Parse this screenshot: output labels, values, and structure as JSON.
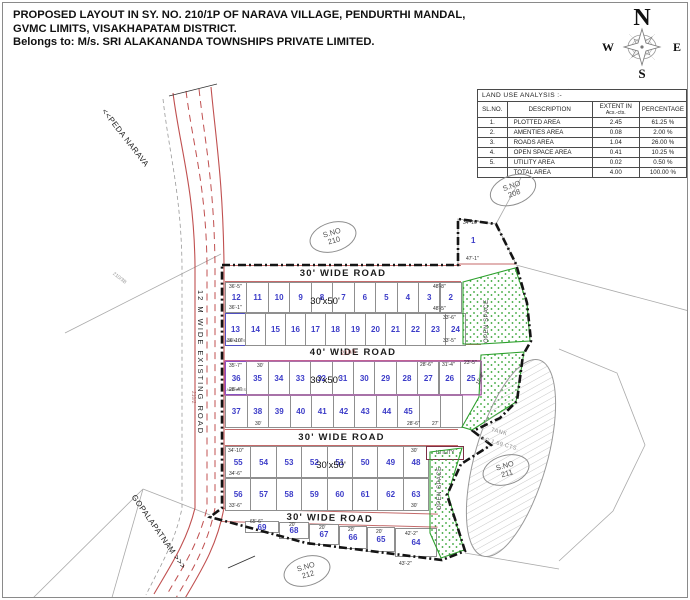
{
  "title": {
    "line1": "PROPOSED LAYOUT IN SY. NO. 210/1P OF NARAVA VILLAGE, PENDURTHI MANDAL,",
    "line2": "GVMC LIMITS, VISAKHAPATAM DISTRICT.",
    "line3": "Belongs to: M/s. SRI ALAKANANDA TOWNSHIPS PRIVATE LIMITED."
  },
  "compass": {
    "n": "N",
    "e": "E",
    "s": "S",
    "w": "W"
  },
  "table": {
    "title": "LAND USE ANALYSIS :-",
    "headers": {
      "c1": "SL.NO.",
      "c2": "DESCRIPTION",
      "c3a": "EXTENT IN",
      "c3b": "Acs.-cts.",
      "c4": "PERCENTAGE"
    },
    "rows": [
      [
        "1.",
        "PLOTTED  AREA",
        "2.45",
        "61.25 %"
      ],
      [
        "2.",
        "AMENTIES  AREA",
        "0.08",
        "2.00 %"
      ],
      [
        "3.",
        "ROADS  AREA",
        "1.04",
        "26.00 %"
      ],
      [
        "4.",
        "OPEN SPACE AREA",
        "0.41",
        "10.25 %"
      ],
      [
        "5.",
        "UTILITY AREA",
        "0.02",
        "0.50 %"
      ],
      [
        "",
        "TOTAL  AREA",
        "4.00",
        "100.00 %"
      ]
    ]
  },
  "roads": [
    {
      "label": "30' WIDE ROAD",
      "x": 222,
      "y": 262,
      "w": 236,
      "h": 17,
      "rot": 0
    },
    {
      "label": "40' WIDE ROAD",
      "x": 222,
      "y": 341,
      "w": 256,
      "h": 17,
      "rot": 0
    },
    {
      "label": "30' WIDE ROAD",
      "x": 222,
      "y": 426,
      "w": 233,
      "h": 17,
      "rot": 0
    },
    {
      "label": "30' WIDE ROAD",
      "x": 219,
      "y": 505,
      "w": 216,
      "h": 14,
      "rot": 1.5
    }
  ],
  "plot_size_labels": [
    {
      "t": "30'x50'",
      "x": 322,
      "y": 293
    },
    {
      "t": "30'x50'",
      "x": 322,
      "y": 372
    },
    {
      "t": "30'x50'",
      "x": 328,
      "y": 457
    }
  ],
  "plots": {
    "rowA1": [
      {
        "n": "12",
        "a": false
      },
      {
        "n": "11"
      },
      {
        "n": "10"
      },
      {
        "n": "9"
      },
      {
        "n": "8"
      },
      {
        "n": "7"
      },
      {
        "n": "6"
      },
      {
        "n": "5"
      },
      {
        "n": "4"
      },
      {
        "n": "3"
      },
      {
        "n": "2"
      }
    ],
    "rowA2": [
      {
        "n": "13",
        "a": true
      },
      {
        "n": "14"
      },
      {
        "n": "15"
      },
      {
        "n": "16"
      },
      {
        "n": "17"
      },
      {
        "n": "18"
      },
      {
        "n": "19"
      },
      {
        "n": "20"
      },
      {
        "n": "21"
      },
      {
        "n": "22"
      },
      {
        "n": "23"
      },
      {
        "n": "24"
      }
    ],
    "rowB1": [
      {
        "n": "36",
        "a": true
      },
      {
        "n": "35"
      },
      {
        "n": "34"
      },
      {
        "n": "33"
      },
      {
        "n": "32"
      },
      {
        "n": "31"
      },
      {
        "n": "30"
      },
      {
        "n": "29"
      },
      {
        "n": "28"
      },
      {
        "n": "27"
      },
      {
        "n": "26"
      },
      {
        "n": "25"
      }
    ],
    "rowB2": [
      {
        "n": "37"
      },
      {
        "n": "38"
      },
      {
        "n": "39"
      },
      {
        "n": "40"
      },
      {
        "n": "41"
      },
      {
        "n": "42"
      },
      {
        "n": "43"
      },
      {
        "n": "44"
      },
      {
        "n": "45"
      },
      {
        "n": ""
      },
      {
        "n": ""
      }
    ],
    "rowC1": [
      {
        "n": "55"
      },
      {
        "n": "54"
      },
      {
        "n": "53"
      },
      {
        "n": "52"
      },
      {
        "n": "51"
      },
      {
        "n": "50"
      },
      {
        "n": "49"
      },
      {
        "n": "48"
      }
    ],
    "rowC2": [
      {
        "n": "56"
      },
      {
        "n": "57"
      },
      {
        "n": "58"
      },
      {
        "n": "59"
      },
      {
        "n": "60"
      },
      {
        "n": "61"
      },
      {
        "n": "62"
      },
      {
        "n": "63"
      }
    ],
    "bottom": [
      {
        "n": "69"
      },
      {
        "n": "68"
      },
      {
        "n": "67"
      },
      {
        "n": "66"
      },
      {
        "n": "65"
      },
      {
        "n": "64"
      }
    ],
    "plot1": "1"
  },
  "labels": {
    "amenities": "AMENITIES",
    "open_space": "OPEN SPACE",
    "utility": "UTILITY",
    "tank_line1": "TANK",
    "tank_line2": "AC 1.69 CTS.",
    "peda_narava": "<<PEDA NARAVA",
    "gopalapatnam": "GOPALAPATNAM >>>",
    "existing_road": "12 M WIDE EXISTING ROAD",
    "sy_210_1": "210/1",
    "sy_210_2": "210/2",
    "sy_210_3b": "210/3B"
  },
  "open_space_labels": [
    {
      "x": 481,
      "y": 340
    },
    {
      "x": 434,
      "y": 507
    }
  ],
  "survey_markers": [
    {
      "l1": "S.NO",
      "l2": "208",
      "x": 486,
      "y": 172,
      "r": -20
    },
    {
      "l1": "S.NO",
      "l2": "210",
      "x": 306,
      "y": 219,
      "r": -16
    },
    {
      "l1": "S.NO",
      "l2": "211",
      "x": 479,
      "y": 452,
      "r": -16
    },
    {
      "l1": "S.NO",
      "l2": "212",
      "x": 280,
      "y": 553,
      "r": -16
    }
  ],
  "dim_labels": [
    {
      "t": "36'-5\"",
      "x": 226,
      "y": 281
    },
    {
      "t": "36'-1\"",
      "x": 226,
      "y": 302
    },
    {
      "t": "36'-10\"",
      "x": 224,
      "y": 335
    },
    {
      "t": "34'-10\"",
      "x": 460,
      "y": 217
    },
    {
      "t": "47'-1\"",
      "x": 463,
      "y": 253
    },
    {
      "t": "48'-8\"",
      "x": 430,
      "y": 281
    },
    {
      "t": "48'-5\"",
      "x": 430,
      "y": 303
    },
    {
      "t": "33'-6\"",
      "x": 440,
      "y": 312
    },
    {
      "t": "33'-5\"",
      "x": 440,
      "y": 335
    },
    {
      "t": "35'-7\"",
      "x": 226,
      "y": 360
    },
    {
      "t": "28'-4\"",
      "x": 226,
      "y": 384
    },
    {
      "t": "30'",
      "x": 254,
      "y": 360
    },
    {
      "t": "28'-6\"",
      "x": 417,
      "y": 359
    },
    {
      "t": "31'-4\"",
      "x": 439,
      "y": 359
    },
    {
      "t": "23'-5\"",
      "x": 461,
      "y": 357
    },
    {
      "t": "15'-8\"",
      "x": 472,
      "y": 380,
      "r": -62
    },
    {
      "t": "30'",
      "x": 252,
      "y": 418
    },
    {
      "t": "28'-6\"",
      "x": 404,
      "y": 418
    },
    {
      "t": "27'",
      "x": 429,
      "y": 418
    },
    {
      "t": "34'-10\"",
      "x": 225,
      "y": 445
    },
    {
      "t": "34'-6\"",
      "x": 226,
      "y": 468
    },
    {
      "t": "33'-6\"",
      "x": 226,
      "y": 500
    },
    {
      "t": "30'",
      "x": 408,
      "y": 445
    },
    {
      "t": "30'",
      "x": 408,
      "y": 500
    },
    {
      "t": "65'-6\"",
      "x": 247,
      "y": 516
    },
    {
      "t": "20'",
      "x": 286,
      "y": 519
    },
    {
      "t": "20'",
      "x": 316,
      "y": 522
    },
    {
      "t": "20'",
      "x": 345,
      "y": 524
    },
    {
      "t": "20'",
      "x": 373,
      "y": 526
    },
    {
      "t": "42'-2\"",
      "x": 402,
      "y": 528
    },
    {
      "t": "43'-2\"",
      "x": 396,
      "y": 558
    }
  ]
}
